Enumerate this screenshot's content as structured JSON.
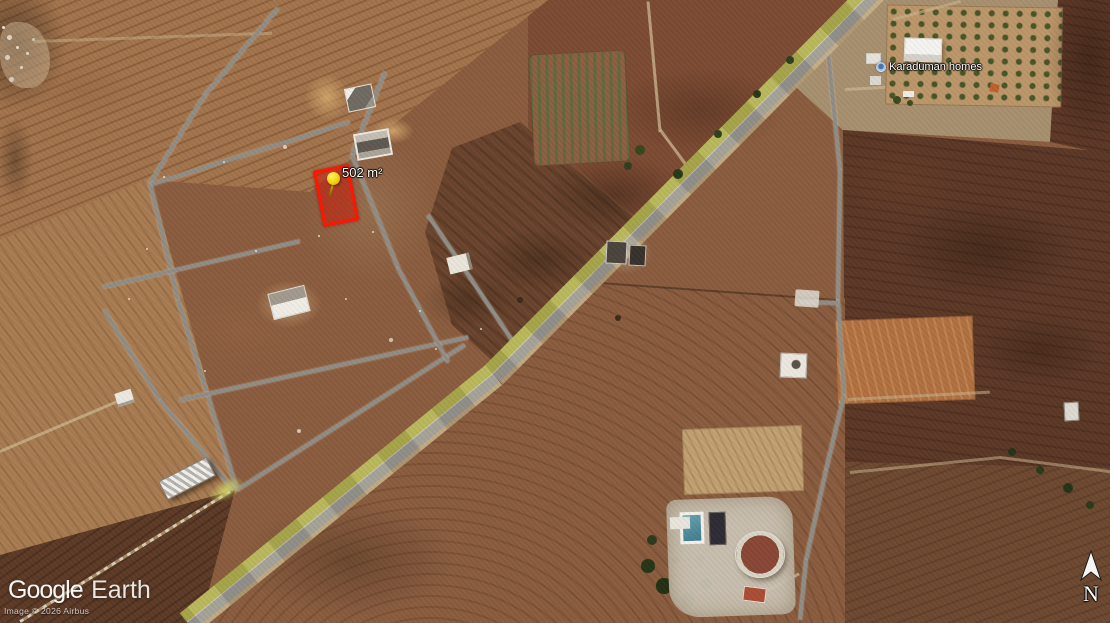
{
  "map": {
    "parcel": {
      "area_label": "502 m²",
      "border_color": "#ff1500",
      "fill_color": "rgba(200,25,10,0.55)"
    },
    "place": {
      "label": "Karaduman homes"
    },
    "logo": {
      "google": "Google",
      "earth": "Earth"
    },
    "attribution": "Image © 2026 Airbus",
    "compass": {
      "north": "N"
    },
    "icons": {
      "parcel_marker": "yellow-pushpin-icon",
      "place_marker": "place-dot-icon",
      "compass": "north-arrow-icon"
    },
    "colors": {
      "terrain_base": "#8a5c3e",
      "road_gray": "#8f8d86",
      "highway_green_strip": "#b2b14f",
      "pushpin_yellow": "#f2cf00"
    }
  }
}
